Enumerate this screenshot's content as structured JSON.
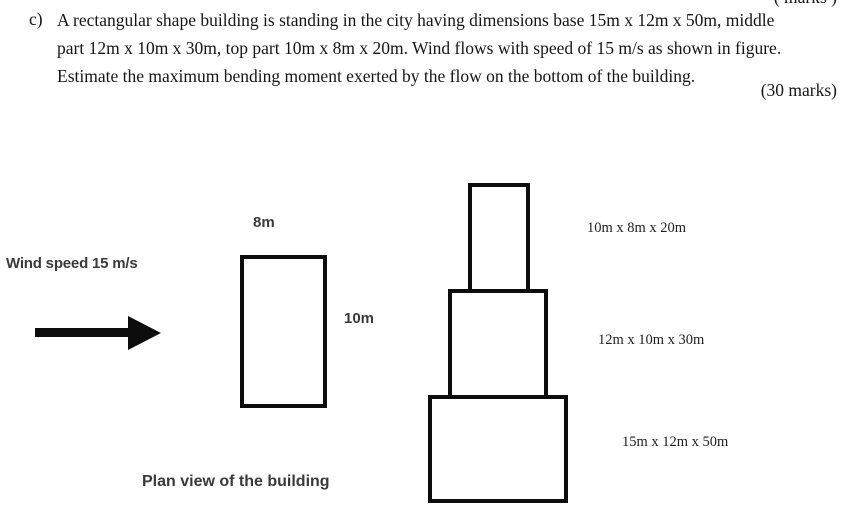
{
  "question": {
    "number": "c)",
    "lines": [
      "A rectangular shape building is standing in the city having dimensions base 15m x 12m x 50m, middle",
      "part 12m x 10m x 30m, top part 10m x 8m x 20m. Wind flows with speed of 15 m/s as shown in figure.",
      "Estimate the maximum bending moment exerted by the flow on the bottom of the building."
    ],
    "marks": "(30 marks)",
    "clipped_fragment_above": "( marks )"
  },
  "figure": {
    "wind_label": "Wind speed 15 m/s",
    "wind_arrow_icon": "right-arrow",
    "plan_view": {
      "width_label": "8m",
      "depth_label": "10m",
      "caption": "Plan view of the building"
    },
    "elevation": {
      "top_section_label": "10m x 8m x 20m",
      "middle_section_label": "12m x 10m x 30m",
      "bottom_section_label": "15m x 12m x 50m"
    }
  },
  "colors": {
    "background": "#ffffff",
    "ink": "#151515",
    "figure_ink": "#0d0d0d",
    "sans_label_ink": "#3a3a3a"
  }
}
